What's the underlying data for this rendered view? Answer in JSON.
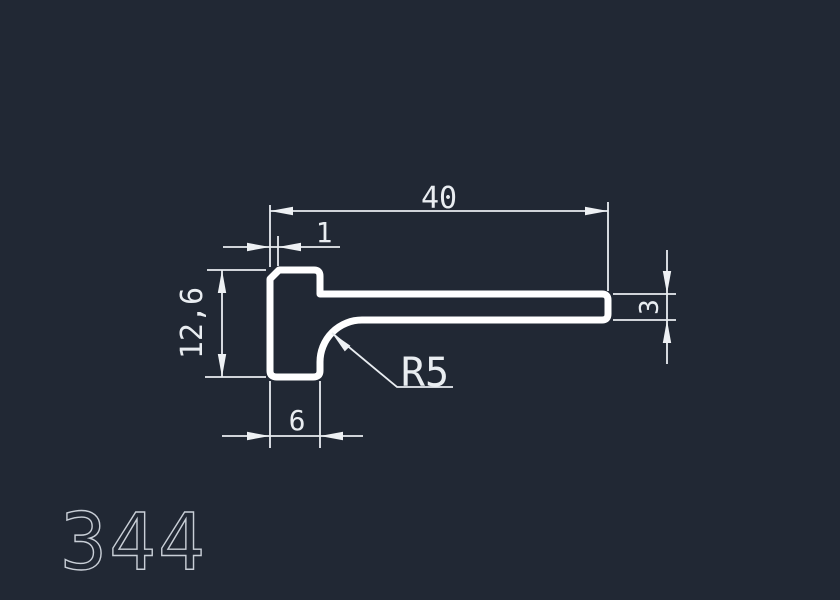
{
  "drawing": {
    "part_number": "344",
    "dimensions": {
      "top_width": "40",
      "top_offset": "1",
      "left_height": "12,6",
      "right_thickness": "3",
      "bottom_width": "6",
      "fillet_radius": "R5"
    },
    "colors": {
      "background": "#212834",
      "profile_line": "#ffffff",
      "dimension_line": "#e9edf1",
      "part_number_label": "#c9cfd7"
    }
  }
}
